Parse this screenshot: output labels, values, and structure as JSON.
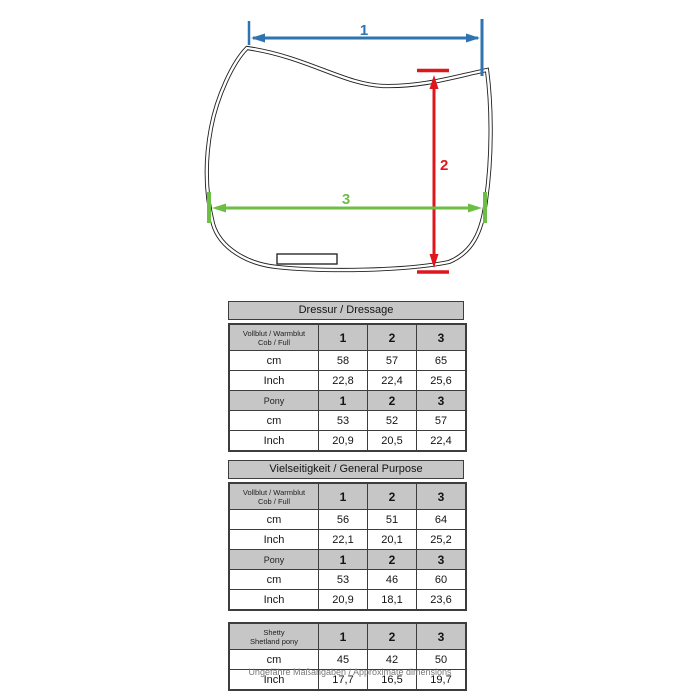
{
  "diagram": {
    "measure_1": "1",
    "measure_2": "2",
    "measure_3": "3",
    "colors": {
      "measure_1": "#2e73b2",
      "measure_2": "#e0161d",
      "measure_3": "#6dbe45",
      "outline": "#1f1f1f"
    }
  },
  "table_style": {
    "header_bg": "#c6c6c6",
    "border": "#3d3d3d"
  },
  "tables": {
    "dressage": {
      "title": "Dressur / Dressage",
      "size_header": {
        "line1": "Vollblut / Warmblut",
        "line2": "Cob / Full",
        "c1": "1",
        "c2": "2",
        "c3": "3"
      },
      "rows_full": [
        {
          "label": "cm",
          "c1": "58",
          "c2": "57",
          "c3": "65"
        },
        {
          "label": "Inch",
          "c1": "22,8",
          "c2": "22,4",
          "c3": "25,6"
        }
      ],
      "pony_header": {
        "label": "Pony",
        "c1": "1",
        "c2": "2",
        "c3": "3"
      },
      "rows_pony": [
        {
          "label": "cm",
          "c1": "53",
          "c2": "52",
          "c3": "57"
        },
        {
          "label": "Inch",
          "c1": "20,9",
          "c2": "20,5",
          "c3": "22,4"
        }
      ]
    },
    "general_purpose": {
      "title": "Vielseitigkeit / General Purpose",
      "size_header": {
        "line1": "Vollblut / Warmblut",
        "line2": "Cob / Full",
        "c1": "1",
        "c2": "2",
        "c3": "3"
      },
      "rows_full": [
        {
          "label": "cm",
          "c1": "56",
          "c2": "51",
          "c3": "64"
        },
        {
          "label": "Inch",
          "c1": "22,1",
          "c2": "20,1",
          "c3": "25,2"
        }
      ],
      "pony_header": {
        "label": "Pony",
        "c1": "1",
        "c2": "2",
        "c3": "3"
      },
      "rows_pony": [
        {
          "label": "cm",
          "c1": "53",
          "c2": "46",
          "c3": "60"
        },
        {
          "label": "Inch",
          "c1": "20,9",
          "c2": "18,1",
          "c3": "23,6"
        }
      ]
    },
    "shetty": {
      "size_header": {
        "line1": "Shetty",
        "line2": "Shetland pony",
        "c1": "1",
        "c2": "2",
        "c3": "3"
      },
      "rows": [
        {
          "label": "cm",
          "c1": "45",
          "c2": "42",
          "c3": "50"
        },
        {
          "label": "Inch",
          "c1": "17,7",
          "c2": "16,5",
          "c3": "19,7"
        }
      ]
    }
  },
  "footer": {
    "note": "Ungefähre Maßangaben / Approximate dimensions"
  }
}
